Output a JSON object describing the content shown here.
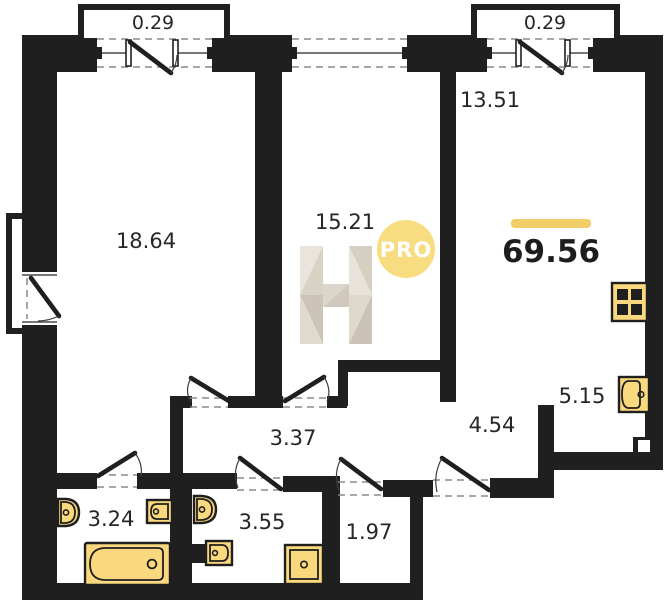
{
  "plan_type": "apartment-floor-plan",
  "total": {
    "area": "69.56"
  },
  "balconies": [
    {
      "area": "0.29"
    },
    {
      "area": "0.29"
    }
  ],
  "rooms": [
    {
      "name": "bedroom",
      "area": "18.64"
    },
    {
      "name": "room",
      "area": "15.21"
    },
    {
      "name": "kitchen-living-room",
      "area": "13.51"
    },
    {
      "name": "kitchen-zone",
      "area": "5.15"
    },
    {
      "name": "hallway",
      "area": "4.54"
    },
    {
      "name": "corridor",
      "area": "3.37"
    },
    {
      "name": "bathroom",
      "area": "3.24"
    },
    {
      "name": "shower-room",
      "area": "3.55"
    },
    {
      "name": "storage",
      "area": "1.97"
    }
  ],
  "watermark": {
    "letter": "H",
    "badge": "PRO"
  },
  "fixtures": [
    "toilet-icon",
    "wash-basin-icon",
    "bathtub-icon",
    "toilet-icon",
    "wash-basin-icon",
    "shower-tray-icon",
    "stove-icon",
    "kitchen-sink-icon"
  ],
  "colors": {
    "walls": "#1f1f1f",
    "fixtures": "#FAD87E",
    "accent_bar": "#F2CE68",
    "badge": "#F8DC80",
    "watermark_light": "#EAE5DC",
    "watermark_dark": "#CCC5B7",
    "label_text": "#262626"
  }
}
